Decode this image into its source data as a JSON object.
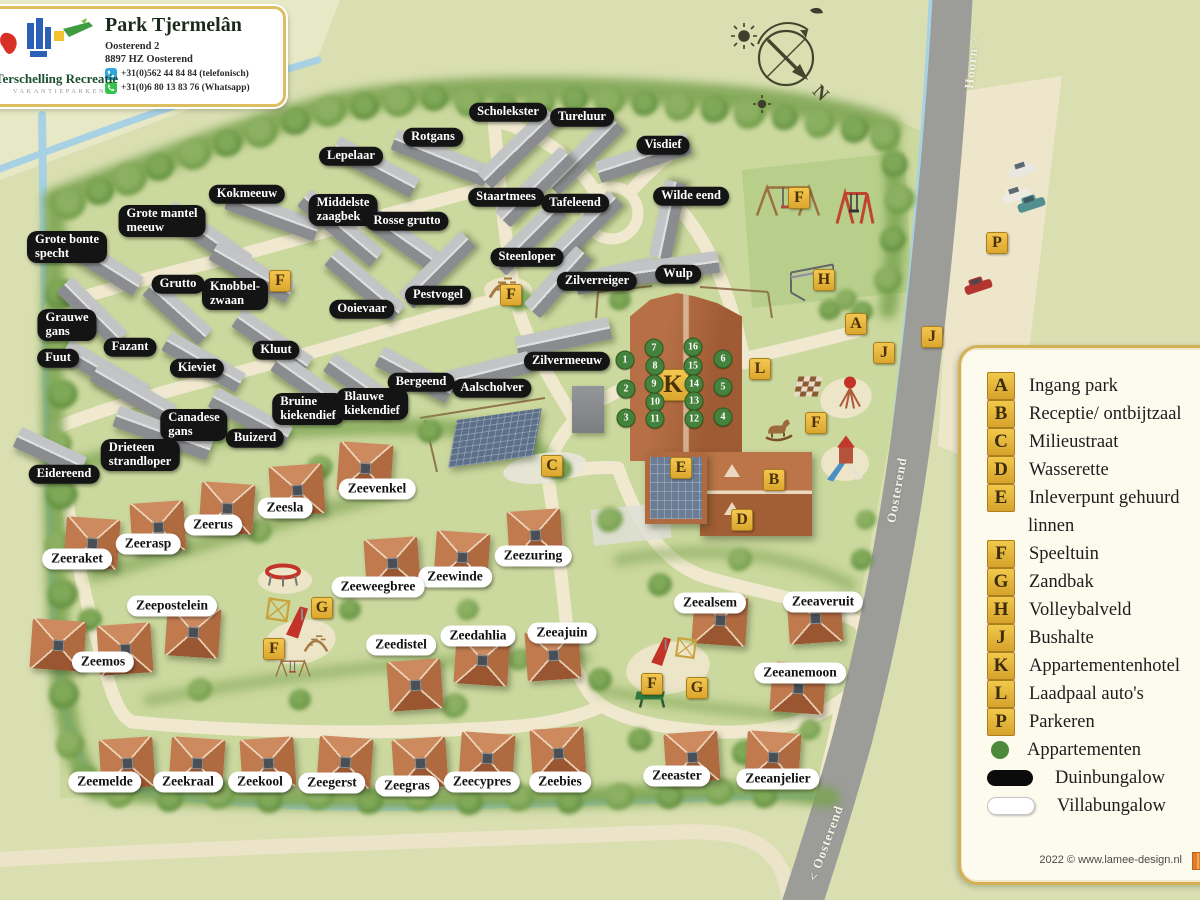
{
  "header": {
    "title": "Park Tjermelân",
    "address_line1": "Oosterend 2",
    "address_line2": "8897 HZ Oosterend",
    "phone": "+31(0)562 44 84 84 (telefonisch)",
    "whatsapp": "+31(0)6 80 13 83 76 (Whatsapp)",
    "logo_title": "Terschelling Recreatie",
    "logo_subtitle": "VAKANTIEPARKEN"
  },
  "legend": {
    "items": [
      {
        "key": "A",
        "label": "Ingang park"
      },
      {
        "key": "B",
        "label": "Receptie/ ontbijtzaal"
      },
      {
        "key": "C",
        "label": "Milieustraat"
      },
      {
        "key": "D",
        "label": "Wasserette"
      },
      {
        "key": "E",
        "label": "Inleverpunt gehuurd",
        "label2": "linnen"
      },
      {
        "key": "F",
        "label": "Speeltuin"
      },
      {
        "key": "G",
        "label": "Zandbak"
      },
      {
        "key": "H",
        "label": "Volleybalveld"
      },
      {
        "key": "J",
        "label": "Bushalte"
      },
      {
        "key": "K",
        "label": "Appartementenhotel"
      },
      {
        "key": "L",
        "label": "Laadpaal auto's"
      },
      {
        "key": "P",
        "label": "Parkeren"
      }
    ],
    "symbols": [
      {
        "type": "dot",
        "label": "Appartementen"
      },
      {
        "type": "black-pill",
        "label": "Duinbungalow"
      },
      {
        "type": "white-pill",
        "label": "Villabungalow"
      }
    ],
    "credit": "2022 © www.lamee-design.nl"
  },
  "map": {
    "compass_n": "N",
    "road_labels": [
      [
        "Hoorn >",
        972,
        62,
        -84
      ],
      [
        "Oosterend",
        897,
        490,
        -80
      ],
      [
        "< Oosterend",
        826,
        843,
        -70
      ]
    ],
    "duin_labels": [
      [
        "Scholekster",
        508,
        112
      ],
      [
        "Tureluur",
        582,
        117
      ],
      [
        "Visdief",
        663,
        145
      ],
      [
        "Rotgans",
        433,
        137
      ],
      [
        "Lepelaar",
        351,
        156
      ],
      [
        "Kokmeeuw",
        247,
        194
      ],
      [
        "Grote mantel|meeuw",
        162,
        221
      ],
      [
        "Middelste|zaagbek",
        343,
        210
      ],
      [
        "Rosse grutto",
        407,
        221
      ],
      [
        "Staartmees",
        506,
        197
      ],
      [
        "Tafeleend",
        575,
        203
      ],
      [
        "Wilde eend",
        691,
        196
      ],
      [
        "Grote bonte|specht",
        67,
        247
      ],
      [
        "Steenloper",
        527,
        257
      ],
      [
        "Zilverreiger",
        597,
        281
      ],
      [
        "Wulp",
        678,
        274
      ],
      [
        "Grutto",
        178,
        284
      ],
      [
        "Knobbel-|zwaan",
        235,
        294
      ],
      [
        "Ooievaar",
        362,
        309
      ],
      [
        "Pestvogel",
        438,
        295
      ],
      [
        "Grauwe|gans",
        67,
        325
      ],
      [
        "Fuut",
        58,
        358
      ],
      [
        "Fazant",
        130,
        347
      ],
      [
        "Kieviet",
        197,
        368
      ],
      [
        "Kluut",
        276,
        350
      ],
      [
        "Zilvermeeuw",
        567,
        361
      ],
      [
        "Bergeend",
        421,
        382
      ],
      [
        "Aalscholver",
        492,
        388
      ],
      [
        "Bruine|kiekendief",
        308,
        409
      ],
      [
        "Blauwe|kiekendief",
        372,
        404
      ],
      [
        "Canadese|gans",
        194,
        425
      ],
      [
        "Buizerd",
        255,
        438
      ],
      [
        "Drieteen|strandloper",
        140,
        455
      ],
      [
        "Eidereend",
        64,
        474
      ]
    ],
    "villa_labels": [
      [
        "Zeevenkel",
        377,
        489
      ],
      [
        "Zeesla",
        285,
        508
      ],
      [
        "Zeerus",
        213,
        525
      ],
      [
        "Zeerasp",
        148,
        544
      ],
      [
        "Zeeraket",
        77,
        559
      ],
      [
        "Zeezuring",
        533,
        556
      ],
      [
        "Zeewinde",
        455,
        577
      ],
      [
        "Zeeweegbree",
        378,
        587
      ],
      [
        "Zeepostelein",
        172,
        606
      ],
      [
        "Zeemos",
        103,
        662
      ],
      [
        "Zeedistel",
        401,
        645
      ],
      [
        "Zeedahlia",
        478,
        636
      ],
      [
        "Zeeajuin",
        562,
        633
      ],
      [
        "Zeealsem",
        710,
        603
      ],
      [
        "Zeeaveruit",
        823,
        602
      ],
      [
        "Zeeanemoon",
        800,
        673
      ],
      [
        "Zeemelde",
        105,
        782
      ],
      [
        "Zeekraal",
        188,
        782
      ],
      [
        "Zeekool",
        260,
        782
      ],
      [
        "Zeegerst",
        332,
        783
      ],
      [
        "Zeegras",
        407,
        786
      ],
      [
        "Zeecypres",
        482,
        782
      ],
      [
        "Zeebies",
        560,
        782
      ],
      [
        "Zeeaster",
        677,
        776
      ],
      [
        "Zeeanjelier",
        778,
        779
      ]
    ],
    "markers": [
      [
        "F",
        280,
        281
      ],
      [
        "F",
        511,
        295
      ],
      [
        "F",
        799,
        198
      ],
      [
        "H",
        824,
        280
      ],
      [
        "P",
        997,
        243
      ],
      [
        "A",
        856,
        324
      ],
      [
        "J",
        884,
        353
      ],
      [
        "J",
        932,
        337
      ],
      [
        "L",
        760,
        369
      ],
      [
        "K",
        673,
        385,
        1
      ],
      [
        "C",
        552,
        466
      ],
      [
        "E",
        681,
        468
      ],
      [
        "B",
        774,
        480
      ],
      [
        "D",
        742,
        520
      ],
      [
        "F",
        816,
        423
      ],
      [
        "G",
        322,
        608
      ],
      [
        "F",
        274,
        649
      ],
      [
        "F",
        652,
        684
      ],
      [
        "G",
        697,
        688
      ]
    ],
    "apartment_numbers": [
      [
        1,
        625,
        360
      ],
      [
        2,
        626,
        389
      ],
      [
        3,
        626,
        418
      ],
      [
        7,
        654,
        348
      ],
      [
        8,
        655,
        366
      ],
      [
        9,
        654,
        384
      ],
      [
        10,
        655,
        402
      ],
      [
        11,
        655,
        419
      ],
      [
        16,
        693,
        347
      ],
      [
        15,
        693,
        366
      ],
      [
        14,
        694,
        384
      ],
      [
        13,
        694,
        401
      ],
      [
        12,
        694,
        419
      ],
      [
        6,
        723,
        359
      ],
      [
        5,
        723,
        387
      ],
      [
        4,
        723,
        417
      ]
    ]
  }
}
